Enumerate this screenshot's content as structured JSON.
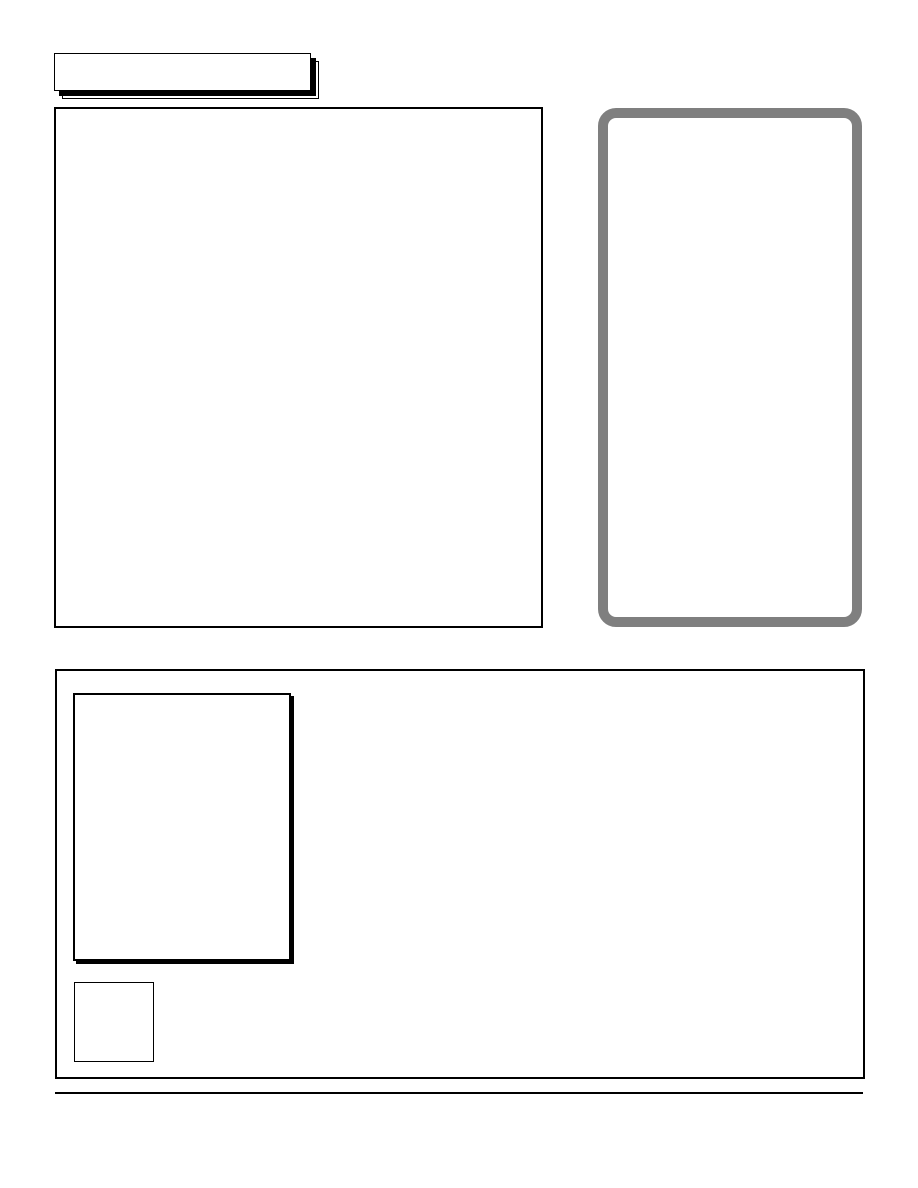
{
  "page": {
    "width": 918,
    "height": 1188,
    "type": "blank-newsletter-template-page"
  },
  "colors": {
    "page_background": "#ffffff",
    "frame_border": "#000000",
    "rounded_frame_border": "#7f7f7f"
  },
  "frames": {
    "title_banner": {
      "label": "",
      "style": "drop-shadow-double-outline"
    },
    "main_article_frame": {
      "content": ""
    },
    "sidebar_rounded_frame": {
      "content": ""
    },
    "lower_section_frame": {
      "content": ""
    },
    "photo_placeholder_frame": {
      "content": ""
    },
    "small_square_frame": {
      "content": ""
    }
  },
  "footer": {
    "rule": true,
    "text": ""
  }
}
